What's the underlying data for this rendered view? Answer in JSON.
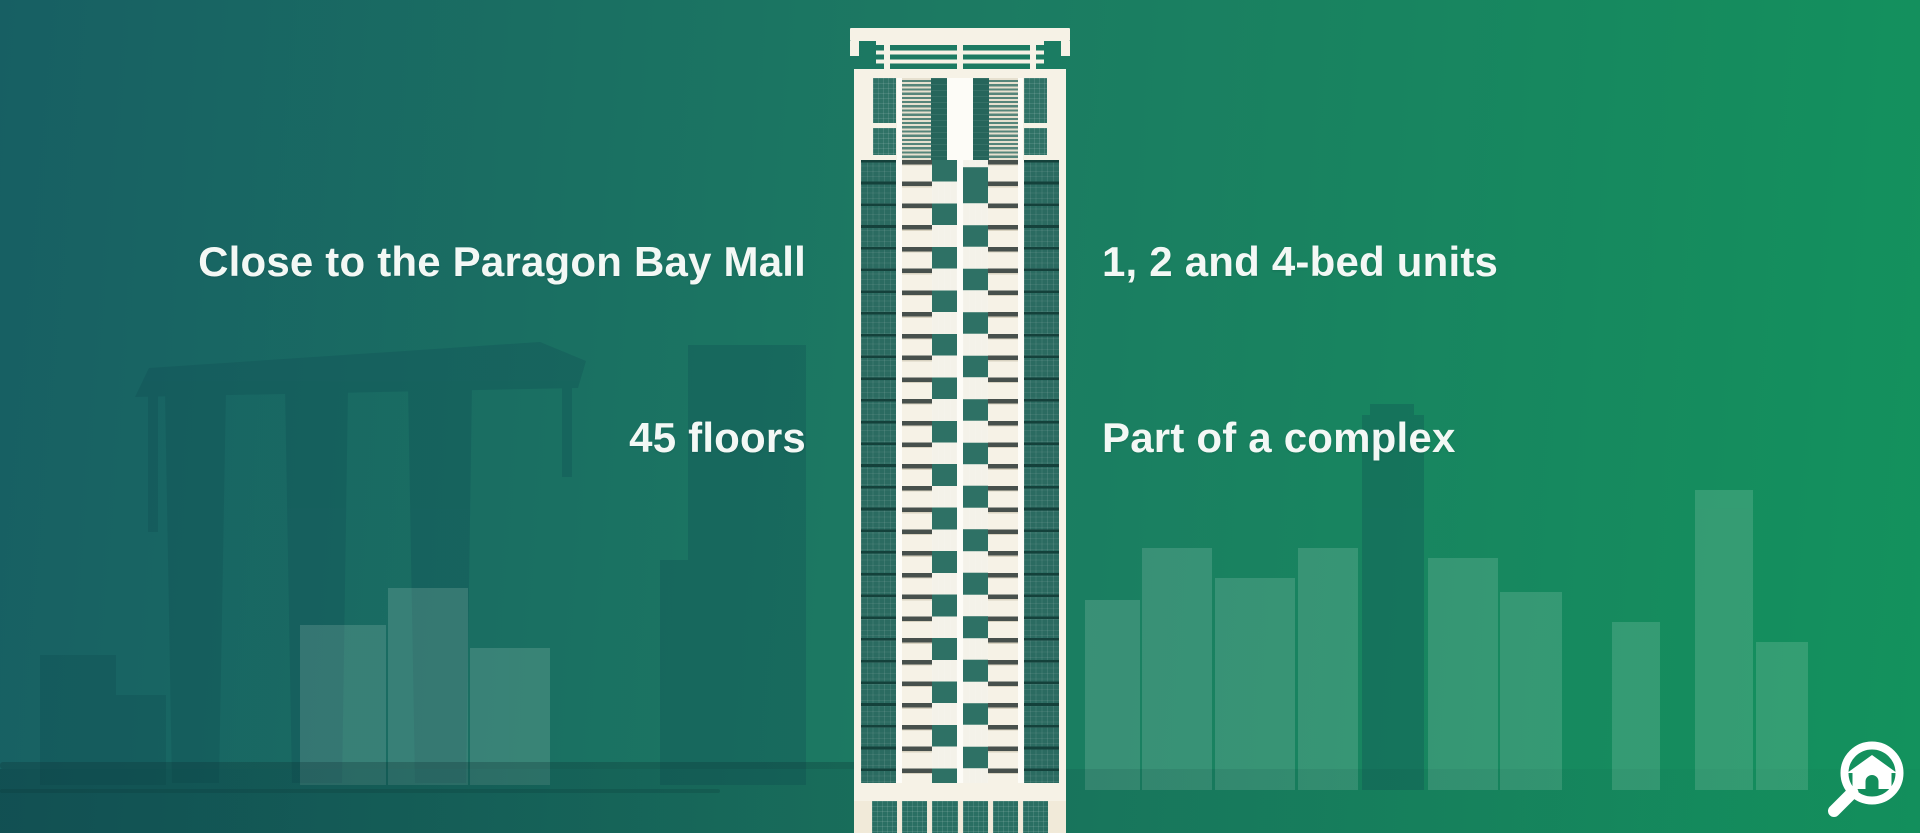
{
  "page": {
    "title": "Building features infographic"
  },
  "features": [
    {
      "id": "mall",
      "label": "Close to the Paragon Bay Mall"
    },
    {
      "id": "units",
      "label": "1, 2 and 4-bed units"
    },
    {
      "id": "floors",
      "label": "45 floors"
    },
    {
      "id": "complex",
      "label": "Part of a complex"
    }
  ],
  "illustration": {
    "building": "high-rise tower with teal glass columns and cream facade",
    "background": "city skyline silhouette with waterfront and bridge"
  },
  "logo": {
    "icon": "magnifier-with-house"
  },
  "colors": {
    "bg_left": "#175f63",
    "bg_mid": "#1c7a62",
    "bg_right": "#13925d",
    "text": "#f3f8f5",
    "cream": "#f1ead9",
    "cream2": "#f6f2e6",
    "white": "#fdfcf7",
    "glass": "#2b6b61",
    "glassline": "#14413b",
    "wteal": "#2e7165",
    "lintel": "#47504c",
    "storeteal": "#2a6f63",
    "logo": "#ffffff"
  }
}
